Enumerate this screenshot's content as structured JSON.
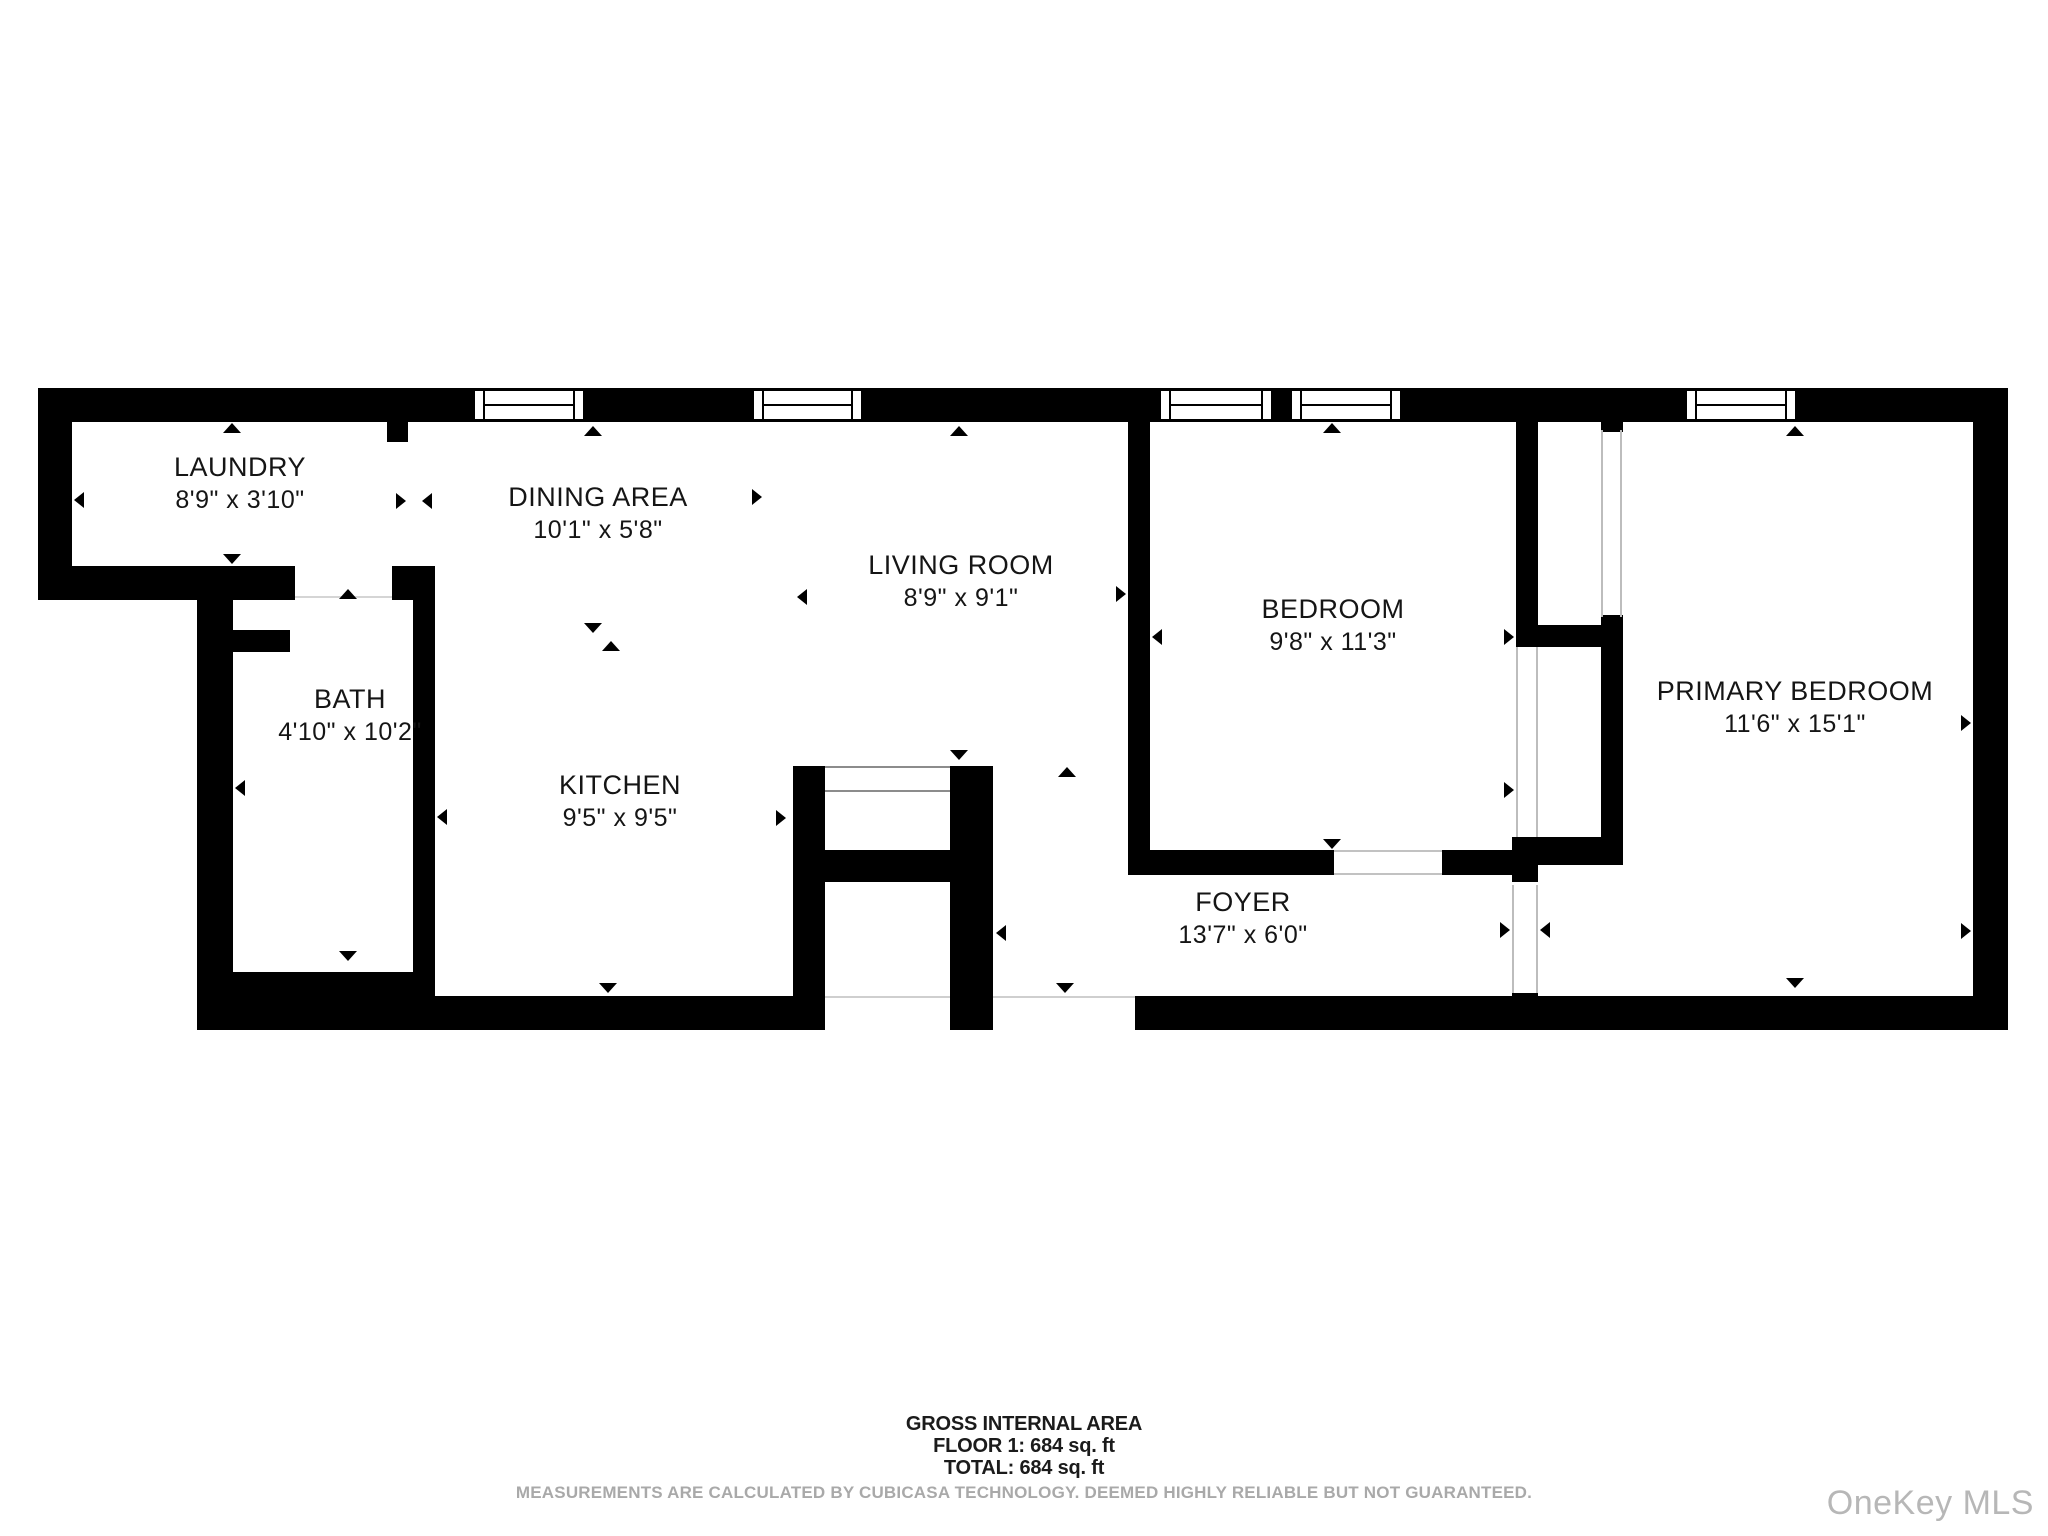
{
  "floor_plan": {
    "wall_color": "#000000",
    "rooms": [
      {
        "name": "LAUNDRY",
        "dims": "8'9\" x 3'10\""
      },
      {
        "name": "DINING AREA",
        "dims": "10'1\" x 5'8\""
      },
      {
        "name": "LIVING ROOM",
        "dims": "8'9\" x 9'1\""
      },
      {
        "name": "BEDROOM",
        "dims": "9'8\" x 11'3\""
      },
      {
        "name": "PRIMARY BEDROOM",
        "dims": "11'6\" x 15'1\""
      },
      {
        "name": "BATH",
        "dims": "4'10\" x 10'2\""
      },
      {
        "name": "KITCHEN",
        "dims": "9'5\" x 9'5\""
      },
      {
        "name": "FOYER",
        "dims": "13'7\" x 6'0\""
      }
    ]
  },
  "footer": {
    "area_title": "GROSS INTERNAL AREA",
    "floor_line": "FLOOR 1: 684 sq. ft",
    "total_line": "TOTAL: 684 sq. ft",
    "disclaimer": "MEASUREMENTS ARE CALCULATED BY CUBICASA TECHNOLOGY. DEEMED HIGHLY RELIABLE BUT NOT GUARANTEED."
  },
  "watermark": {
    "text": "OneKey MLS",
    "color": "#b7b7b7"
  }
}
